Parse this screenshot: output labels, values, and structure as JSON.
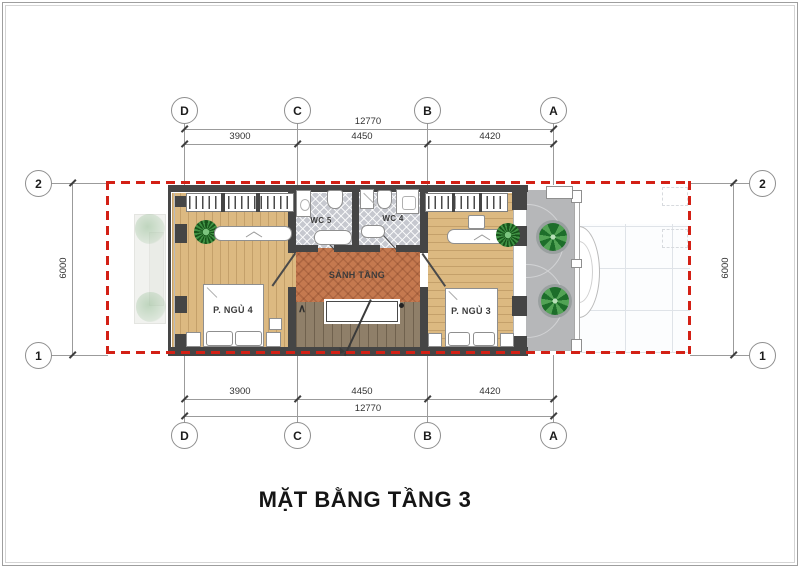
{
  "meta": {
    "drawing_type": "floor-plan"
  },
  "title": "MẶT BẰNG TẦNG 3",
  "grid": {
    "top": [
      "D",
      "C",
      "B",
      "A"
    ],
    "bottom": [
      "D",
      "C",
      "B",
      "A"
    ],
    "left": [
      "2",
      "1"
    ],
    "right": [
      "2",
      "1"
    ]
  },
  "dims": {
    "top": {
      "overall": "12770",
      "segments": [
        "3900",
        "4450",
        "4420"
      ]
    },
    "bottom": {
      "overall": "12770",
      "segments": [
        "3900",
        "4450",
        "4420"
      ]
    },
    "left": "6000",
    "right": "6000"
  },
  "rooms": {
    "bedroom4": "P. NGỦ 4",
    "bedroom3": "P. NGỦ 3",
    "wc5": "WC 5",
    "wc4": "WC 4",
    "hall": "SẢNH TẦNG"
  },
  "stairs": {
    "up_arrow": "∧"
  },
  "colors": {
    "accent_red": "#d32015",
    "wall": "#454545",
    "wood_floor": "#dcb981",
    "herringbone": "#c5794f",
    "stair_wood": "#8f7f69",
    "wc_tile": "#c6c8cf",
    "deck": "#b6b7b9",
    "plant_green": "#2e7d32"
  }
}
